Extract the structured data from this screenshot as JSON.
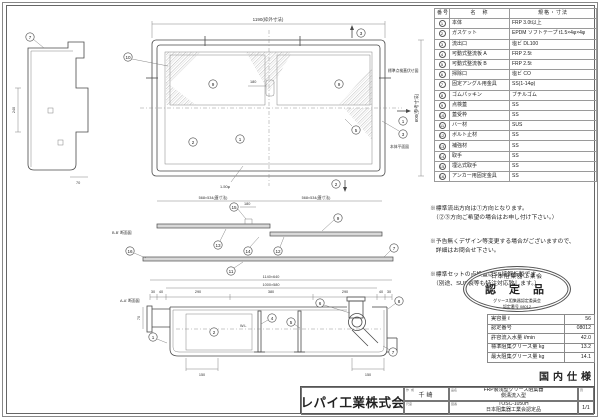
{
  "parts_table": {
    "headers": [
      "番号",
      "名　称",
      "規格・寸法"
    ],
    "rows": [
      {
        "no": "1",
        "name": "本体",
        "spec": "FRP 3.0t以上"
      },
      {
        "no": "2",
        "name": "ガスケット",
        "spec": "EPDM ソフトテープ t1.5×4φ×4φ"
      },
      {
        "no": "3",
        "name": "流出口",
        "spec": "塩ビ DL100"
      },
      {
        "no": "4",
        "name": "可動式整流板 A",
        "spec": "FRP 2.5t"
      },
      {
        "no": "5",
        "name": "可動式整流板 B",
        "spec": "FRP 2.5t"
      },
      {
        "no": "6",
        "name": "掃除口",
        "spec": "塩ビ CO"
      },
      {
        "no": "7",
        "name": "固定アングル用金具",
        "spec": "SS(1-14φ)"
      },
      {
        "no": "8",
        "name": "ゴムパッキン",
        "spec": "ブチルゴム"
      },
      {
        "no": "9",
        "name": "点検蓋",
        "spec": "SS"
      },
      {
        "no": "10",
        "name": "蓋受枠",
        "spec": "SS"
      },
      {
        "no": "11",
        "name": "バー材",
        "spec": "SUS"
      },
      {
        "no": "12",
        "name": "ボルト止材",
        "spec": "SS"
      },
      {
        "no": "13",
        "name": "補強材",
        "spec": "SS"
      },
      {
        "no": "14",
        "name": "取手",
        "spec": "SS"
      },
      {
        "no": "15",
        "name": "埋込式取手",
        "spec": "SS"
      },
      {
        "no": "16",
        "name": "アンカー用固定金具",
        "spec": "SS"
      }
    ]
  },
  "notes": {
    "items": [
      "※標準流出方向は①方向となります。\n　（②③方向ご希望の場合はお申し付け下さい。）",
      "※予告無くデザイン等変更する場合がございますので、\n　詳細はお問合せ下さい。",
      "※標準セットの点検蓋はSS縞鋼板製です。\n　（別途、SUS製等も特注対応致します。）"
    ]
  },
  "stamp": {
    "association": "日本阻集器工業会",
    "title": "認 定 品",
    "committee": "グリース阻集器認定委員会",
    "number": "認定番号 08012"
  },
  "spec_table": {
    "rows": [
      {
        "label": "実容量 ℓ",
        "value": "56"
      },
      {
        "label": "認定番号",
        "value": "08012"
      },
      {
        "label": "許容流入水量 ℓ/min",
        "value": "42.0"
      },
      {
        "label": "標準阻集グリース量 kg",
        "value": "13.2"
      },
      {
        "label": "最大阻集グリース量 kg",
        "value": "14.1"
      }
    ]
  },
  "domestic_spec": "国内仕様",
  "title_block": {
    "company": "プレパイ工業株式会社",
    "drawn_label": "作成",
    "drawn_name": "千崎",
    "scale_label": "尺度",
    "product_label": "品名",
    "product_line1": "FRP製浅型グリース阻集器",
    "product_line2": "側溝流入型",
    "drawing_no_label": "図番",
    "model": "TOSC-1050H",
    "certification": "日本阻集器工業会認定品",
    "page_label": "頁",
    "page": "1/1"
  },
  "drawing": {
    "nums": [
      "1",
      "2",
      "3",
      "4",
      "5",
      "6",
      "7",
      "8",
      "9",
      "10",
      "11",
      "12",
      "13",
      "14",
      "15",
      "16"
    ],
    "plan": {
      "width_dim": "1190(枠外寸法)",
      "height_dim": "600(参考寸法)",
      "lid_plan_label": "標準点検蓋伏せ図",
      "body_plan_label": "本体平面図",
      "handle_dim": "180",
      "hole_note": "1-50φ",
      "lid_dim_left": "568×534(蓋寸法)",
      "lid_dim_right": "568×534(蓋寸法)"
    },
    "lid_section": {
      "label": "B-B' 断面図",
      "handle_dim": "180"
    },
    "body_section": {
      "label": "A-A' 断面図",
      "outer_dim": "1140×640",
      "inner_dim": "1000×580",
      "seg_dims": [
        "30",
        "40",
        "290",
        "380",
        "290",
        "40",
        "30"
      ],
      "left_pit_dim": "150",
      "right_pit_dim": "150",
      "inlet_height_dim": "70",
      "water_line": "W.L"
    },
    "side_view": {
      "depth_dim": "240",
      "bottom_dim": "70"
    }
  }
}
